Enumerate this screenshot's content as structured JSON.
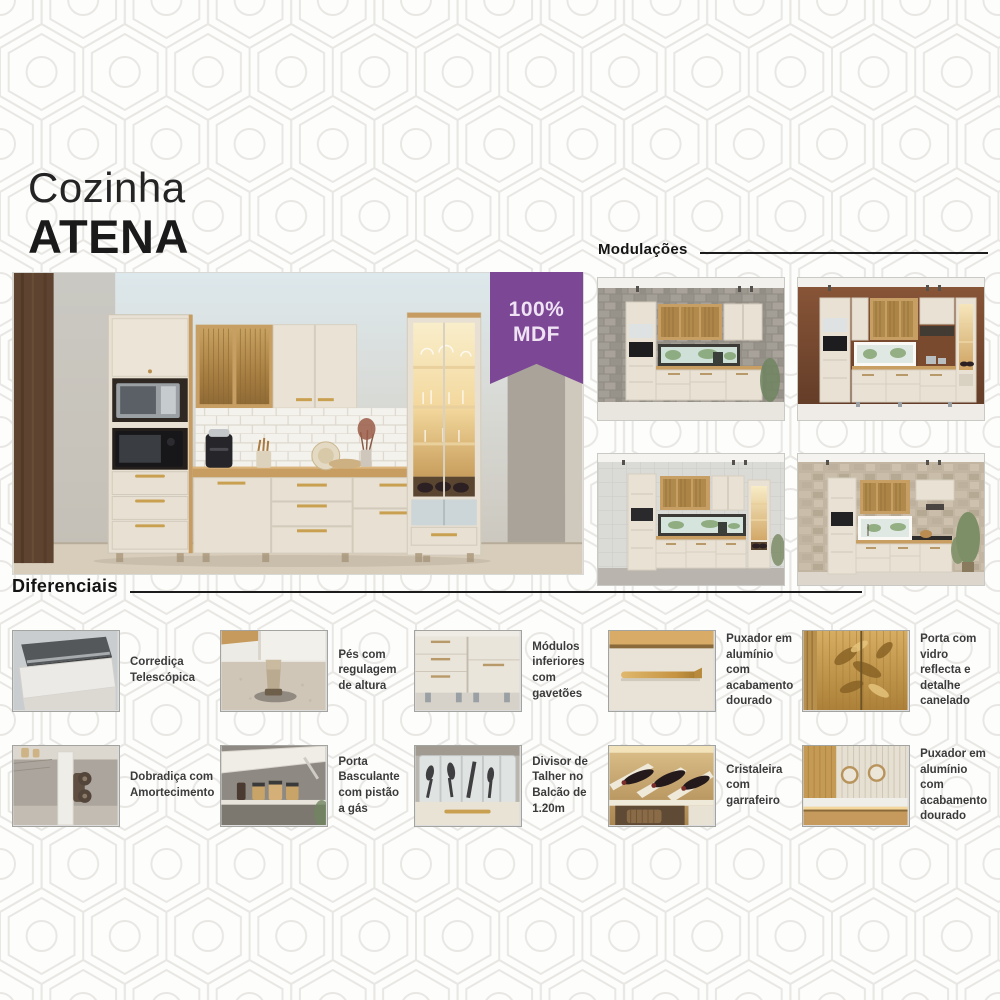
{
  "header": {
    "title_line1": "Cozinha",
    "title_line2": "ATENA"
  },
  "badge": {
    "line1": "100%",
    "line2": "MDF",
    "bg_color": "#7c4795",
    "text_color": "#efe2f3"
  },
  "main_photo": {
    "image": "kitchen-set-atena-photo"
  },
  "modulations": {
    "heading": "Modulações",
    "items": [
      {
        "image": "modulation-gray-brick-wall-kitchen"
      },
      {
        "image": "modulation-copper-wall-kitchen"
      },
      {
        "image": "modulation-light-tile-wall-kitchen"
      },
      {
        "image": "modulation-stone-wall-kitchen-plant"
      }
    ]
  },
  "differentials": {
    "heading": "Diferenciais",
    "features": [
      {
        "label": "Corrediça Telescópica",
        "image": "telescopic-slide-photo"
      },
      {
        "label": "Pés com regulagem de altura",
        "image": "adjustable-feet-photo"
      },
      {
        "label": "Módulos inferiores com gavetões",
        "image": "lower-modules-big-drawers-photo"
      },
      {
        "label": "Puxador em alumínio com acabamento dourado",
        "image": "gold-aluminum-bar-handle-photo"
      },
      {
        "label": "Porta com vidro reflecta e detalhe canelado",
        "image": "reflecta-glass-fluted-door-photo"
      },
      {
        "label": "Dobradiça com Amortecimento",
        "image": "soft-close-hinge-photo"
      },
      {
        "label": "Porta Basculante com pistão a gás",
        "image": "gas-piston-flip-door-photo"
      },
      {
        "label": "Divisor de Talher no Balcão de 1.20m",
        "image": "cutlery-divider-tray-photo"
      },
      {
        "label": "Cristaleira com garrafeiro",
        "image": "glass-cabinet-wine-rack-photo"
      },
      {
        "label": "Puxador em alumínio com acabamento dourado",
        "image": "gold-aluminum-knob-handle-photo"
      }
    ]
  },
  "colors": {
    "accent_purple": "#7c4795",
    "text_dark": "#1a1a1a",
    "cabinet_cream": "#e7e0d3",
    "wood_accent": "#c79d62",
    "pattern_gray": "#e8e7e4"
  }
}
